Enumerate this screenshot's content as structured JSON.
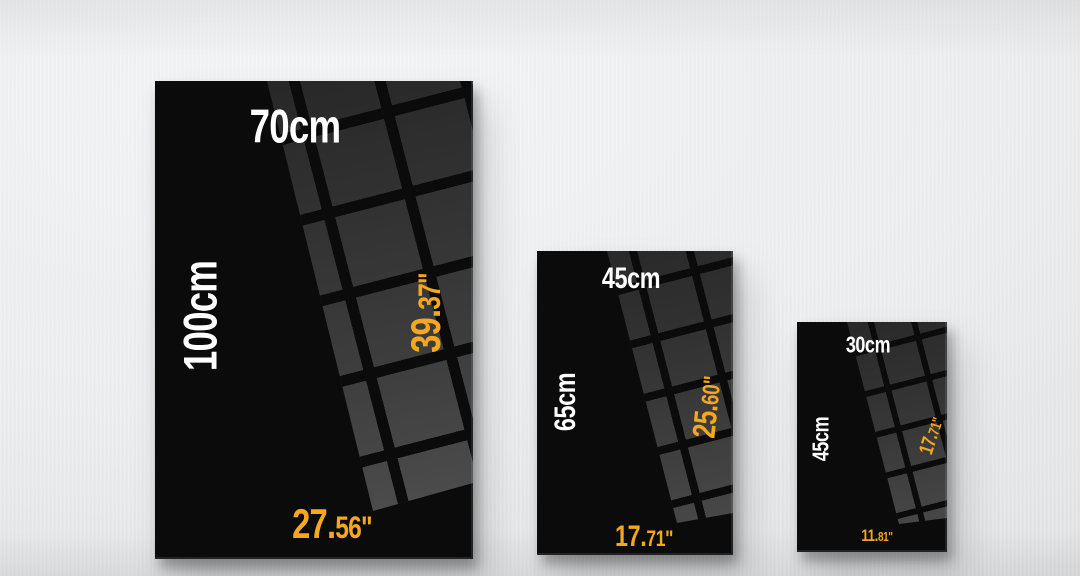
{
  "scene": {
    "description": "Three black canvas prints on a light wall comparing sizes",
    "wall_color": "#ECEEEF",
    "poster_color": "#0B0B0B",
    "reflection_square_color": "#3D3D3D",
    "cm_label_color": "#FFFFFF",
    "inch_label_color": "#F5A71D"
  },
  "posters": [
    {
      "name": "large",
      "width_cm": "70cm",
      "height_cm": "100cm",
      "height_in_main": "39.",
      "height_in_small": "37\"",
      "width_in_main": "27.",
      "width_in_small": "56\""
    },
    {
      "name": "medium",
      "width_cm": "45cm",
      "height_cm": "65cm",
      "height_in_main": "25.",
      "height_in_small": "60\"",
      "width_in_main": "17.",
      "width_in_small": "71\""
    },
    {
      "name": "small",
      "width_cm": "30cm",
      "height_cm": "45cm",
      "height_in_main": "17.",
      "height_in_small": "71\"",
      "width_in_main": "11.",
      "width_in_small": "81\""
    }
  ]
}
